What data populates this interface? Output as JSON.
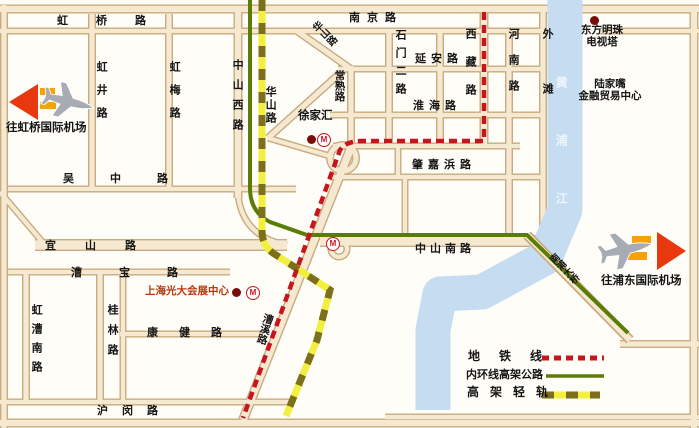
{
  "roads": {
    "hongqiao": "虹桥路",
    "hongjing": "虹井路",
    "hongmei": "虹梅路",
    "zhongshan_west": "中山西路",
    "huashan": "华山路",
    "nanjing": "南京路",
    "changshu": "常熟路",
    "shimen_er": "石门二路",
    "yanan": "延安路",
    "xizang": "西藏路",
    "henan": "河南路",
    "waitan": "外滩",
    "huaihai": "淮海路",
    "zhaojiabang": "肇嘉浜路",
    "wuzhong": "吴中路",
    "yishan": "宜山路",
    "caobao": "漕宝路",
    "zhongshan_south": "中山南路",
    "hongcao_south": "虹漕南路",
    "guilin": "桂林路",
    "kangjian": "康健路",
    "humin": "沪闵路",
    "caoxi": "漕溪路",
    "nanpu_bridge": "南浦大桥"
  },
  "river": {
    "name": "黄浦江"
  },
  "landmarks": {
    "xujiahui": "徐家汇",
    "oriental_pearl": {
      "lines": [
        "东方明珠",
        "电视塔"
      ]
    },
    "lujiazui": {
      "lines": [
        "陆家嘴",
        "金融贸易中心"
      ]
    },
    "everbright": "上海光大会展中心"
  },
  "airports": {
    "hongqiao": "往虹桥国际机场",
    "pudong": "往浦东国际机场"
  },
  "legend": {
    "metro": "地铁线",
    "inner_ring": "内环线高架公路",
    "light_rail": "高架轻轨"
  },
  "icons": {
    "metro_symbol": "M"
  },
  "colors": {
    "metro_red": "#c8141c",
    "ring_green": "#5a7d05",
    "rail_yellow": "#f3ef3f",
    "rail_dash": "#7c701c",
    "river_blue": "#c6dcf0",
    "road_fill": "#f6e9d2",
    "road_edge": "#c9ab7e",
    "arrow_red": "#e8380d",
    "stripe_orange": "#f6a200",
    "dot_dark_red": "#7a0c0c",
    "everbright_text": "#b33a12"
  }
}
